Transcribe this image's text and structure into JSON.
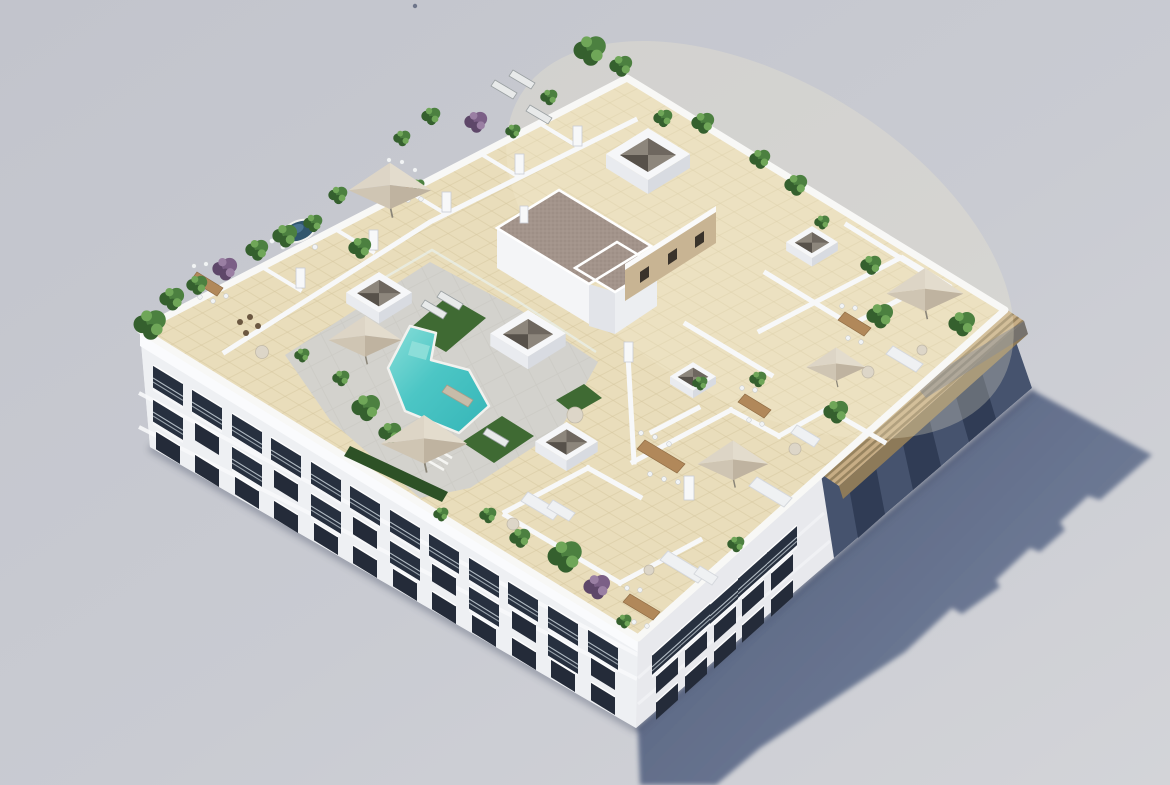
{
  "meta": {
    "title": "Aerial 3D architectural rendering of a white apartment block with landscaped rooftop pool terrace",
    "render_type": "isometric aerial exterior visualisation",
    "visible_text": "none"
  },
  "scene": {
    "description": "Bird's-eye isometric render of a four-storey white apartment building on a neutral grey background. The flat roof is a beige-tiled communal terrace: turquoise stepped swimming pool with artificial turf and sun loungers behind a glass fence, dark oval jacuzzi, L-shaped stair core with brown gravel roof and a sand-coloured wall with small windows, white skylight boxes with pyramidal recesses, private terraces divided by low white walls furnished with beige parasols, wooden dining sets and white sofas, potted palms and purple shrubs along the parapets, and a slatted timber pergola along the upper-right edge. The building casts a long blue-grey shadow to the lower right.",
    "objects": [
      "apartment building",
      "rooftop terraces",
      "swimming pool",
      "jacuzzi",
      "glass pool fence",
      "artificial turf",
      "sun loungers",
      "parasols",
      "wooden dining sets",
      "outdoor sofas",
      "round side tables",
      "potted palm trees",
      "purple shrubs",
      "skylight boxes",
      "stair core with gravel roof",
      "timber pergola",
      "facade windows",
      "balconies",
      "cast shadow"
    ]
  },
  "palette": {
    "bg1": "#c3c5cd",
    "bg2": "#d3d4d9",
    "shadow": "#55627f",
    "shadowfar": "#6c7994",
    "facade": "#eff0f3",
    "cornice": "#fafbfd",
    "facadedark": "#46536e",
    "windark": "#242b39",
    "winbay": "#303c55",
    "rooftile": "#e9ddbb",
    "tileline": "#d5c69e",
    "deck": "#d3d2cd",
    "pool1": "#7edad5",
    "pool2": "#3cbcbd",
    "turf": "#3f6a33",
    "hedge": "#2d5126",
    "gravel": "#a3948b",
    "sandwall": "#c8b493",
    "pergtop": "#c7ad85",
    "pergface": "#8d7a59",
    "umb1": "#ddd5c6",
    "umb2": "#bfb3a0",
    "wood": "#b1885a",
    "wall": "#f7f8f9",
    "wallshade": "#b9bcc6",
    "sofa": "#eff1f3",
    "jacuzzi": "#31566d"
  }
}
